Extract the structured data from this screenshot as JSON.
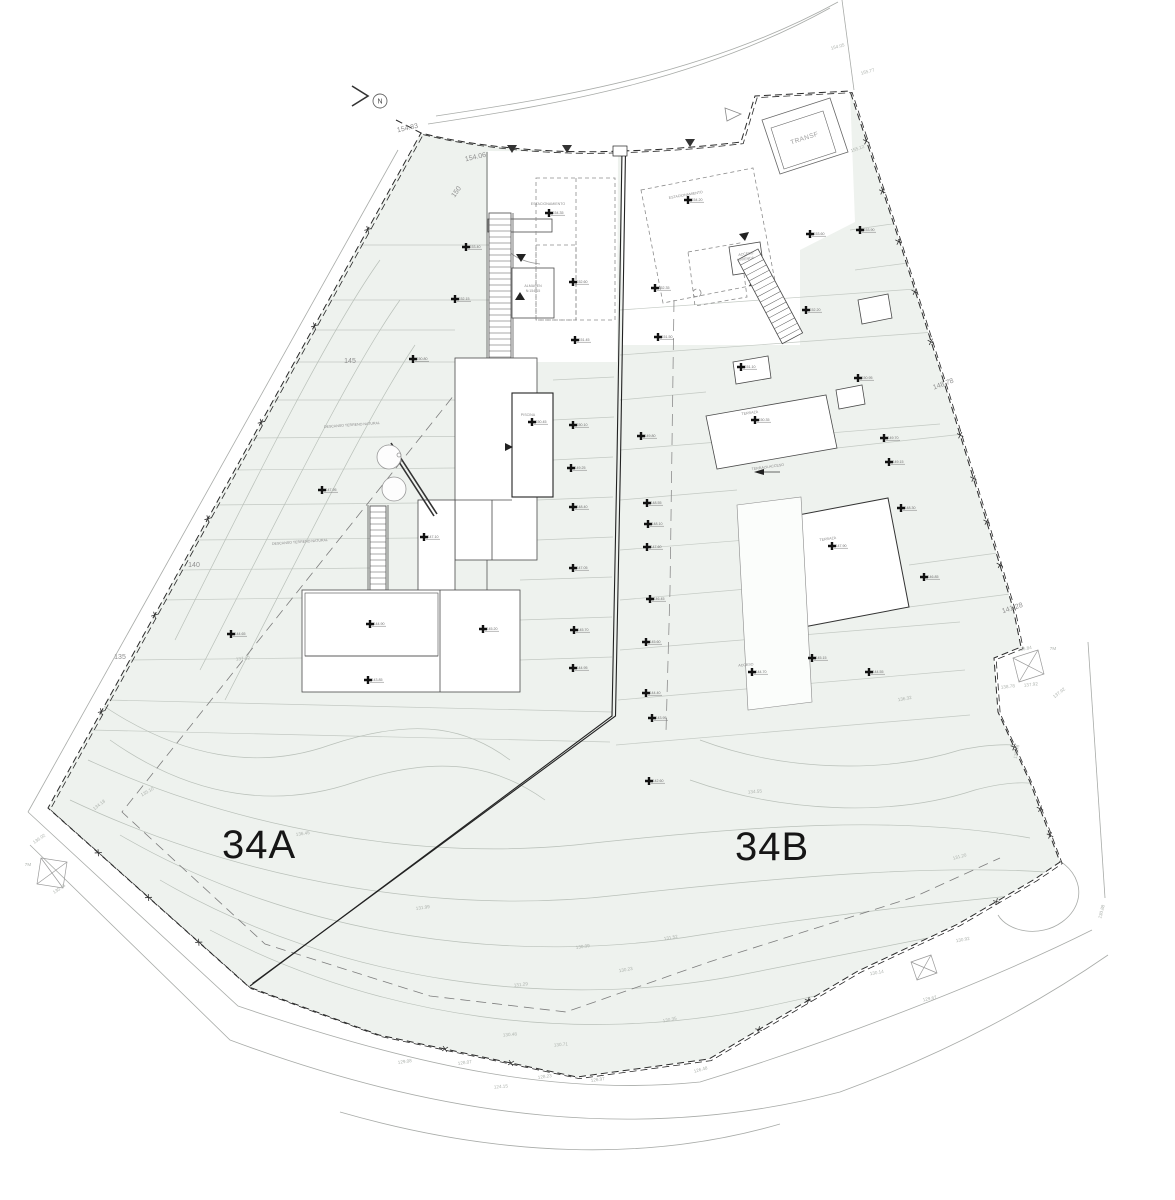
{
  "plan": {
    "parcel_a_label": "34A",
    "parcel_b_label": "34B",
    "north_label": "N",
    "transformer_label": "TRANSF"
  },
  "colors": {
    "terrace_fill": "#eef2ee",
    "line_gray": "#b5bcb5",
    "boundary_black": "#2a2a2a"
  },
  "boundary_labels": [
    {
      "text": "154.83",
      "x": 408,
      "y": 130,
      "rot": -13
    },
    {
      "text": "154.06",
      "x": 476,
      "y": 159,
      "rot": -13
    },
    {
      "text": "150",
      "x": 458,
      "y": 193,
      "rot": -55
    },
    {
      "text": "145",
      "x": 350,
      "y": 363,
      "rot": 0
    },
    {
      "text": "140",
      "x": 194,
      "y": 567,
      "rot": 0
    },
    {
      "text": "135",
      "x": 120,
      "y": 659,
      "rot": 0
    },
    {
      "text": "148.78",
      "x": 944,
      "y": 386,
      "rot": -20
    },
    {
      "text": "141.28",
      "x": 1013,
      "y": 610,
      "rot": -18
    }
  ],
  "contour_labels": [
    {
      "text": "154.05",
      "x": 838,
      "y": 48,
      "rot": -15
    },
    {
      "text": "155.77",
      "x": 868,
      "y": 73,
      "rot": -15
    },
    {
      "text": "155.12",
      "x": 858,
      "y": 150,
      "rot": -20
    },
    {
      "text": "136.84",
      "x": 1025,
      "y": 650,
      "rot": -10
    },
    {
      "text": "138.78",
      "x": 1008,
      "y": 688,
      "rot": -6
    },
    {
      "text": "137.92",
      "x": 1031,
      "y": 686,
      "rot": -6
    },
    {
      "text": "7M",
      "x": 1053,
      "y": 650,
      "rot": 0
    },
    {
      "text": "137.92",
      "x": 1060,
      "y": 694,
      "rot": -38
    },
    {
      "text": "135.78",
      "x": 1018,
      "y": 752,
      "rot": -78
    },
    {
      "text": "130.88",
      "x": 1103,
      "y": 912,
      "rot": -75
    },
    {
      "text": "136.45",
      "x": 303,
      "y": 835,
      "rot": -8
    },
    {
      "text": "137.02",
      "x": 243,
      "y": 660,
      "rot": -5
    },
    {
      "text": "134.18",
      "x": 100,
      "y": 806,
      "rot": -38
    },
    {
      "text": "135.10",
      "x": 148,
      "y": 793,
      "rot": -30
    },
    {
      "text": "136.02",
      "x": 40,
      "y": 840,
      "rot": -35
    },
    {
      "text": "135.46",
      "x": 60,
      "y": 890,
      "rot": -35
    },
    {
      "text": "7M",
      "x": 28,
      "y": 866,
      "rot": 0
    },
    {
      "text": "131.99",
      "x": 423,
      "y": 909,
      "rot": -8
    },
    {
      "text": "131.52",
      "x": 671,
      "y": 939,
      "rot": -10
    },
    {
      "text": "130.99",
      "x": 583,
      "y": 948,
      "rot": -8
    },
    {
      "text": "131.29",
      "x": 521,
      "y": 986,
      "rot": -6
    },
    {
      "text": "130.23",
      "x": 626,
      "y": 971,
      "rot": -10
    },
    {
      "text": "130.48",
      "x": 510,
      "y": 1036,
      "rot": -5
    },
    {
      "text": "130.71",
      "x": 561,
      "y": 1046,
      "rot": -5
    },
    {
      "text": "128.07",
      "x": 465,
      "y": 1064,
      "rot": -8
    },
    {
      "text": "128.23",
      "x": 545,
      "y": 1078,
      "rot": -8
    },
    {
      "text": "126.97",
      "x": 598,
      "y": 1081,
      "rot": -8
    },
    {
      "text": "124.15",
      "x": 501,
      "y": 1088,
      "rot": -5
    },
    {
      "text": "129.08",
      "x": 405,
      "y": 1063,
      "rot": -8
    },
    {
      "text": "126.48",
      "x": 701,
      "y": 1071,
      "rot": -15
    },
    {
      "text": "130.35",
      "x": 670,
      "y": 1021,
      "rot": -12
    },
    {
      "text": "134.55",
      "x": 755,
      "y": 793,
      "rot": -5
    },
    {
      "text": "136.32",
      "x": 905,
      "y": 700,
      "rot": -10
    },
    {
      "text": "131.20",
      "x": 960,
      "y": 858,
      "rot": -15
    },
    {
      "text": "130.92",
      "x": 963,
      "y": 941,
      "rot": -10
    },
    {
      "text": "130.14",
      "x": 877,
      "y": 974,
      "rot": -10
    },
    {
      "text": "129.67",
      "x": 930,
      "y": 1000,
      "rot": -12
    }
  ],
  "building_labels": [
    {
      "text": "DESCANSO TERRENO NATURAL",
      "x": 352,
      "y": 426,
      "rot": -4
    },
    {
      "text": "DESCANSO TERRENO NATURAL",
      "x": 300,
      "y": 543,
      "rot": -4
    },
    {
      "text": "ESTACIONAMIENTO",
      "x": 548,
      "y": 205,
      "rot": 0
    },
    {
      "text": "ESTACIONAMIENTO",
      "x": 686,
      "y": 196,
      "rot": -10
    },
    {
      "text": "TERRAZA ACCESO",
      "x": 768,
      "y": 468,
      "rot": -8
    },
    {
      "text": "PISCINA",
      "x": 528,
      "y": 416,
      "rot": 0
    },
    {
      "text": "TERRAZA",
      "x": 750,
      "y": 414,
      "rot": -8
    },
    {
      "text": "TERRAZA",
      "x": 828,
      "y": 540,
      "rot": -8
    },
    {
      "text": "ACCESO",
      "x": 746,
      "y": 666,
      "rot": -5
    },
    {
      "text": "ALMACEN",
      "x": 533,
      "y": 287,
      "rot": 0
    },
    {
      "text": "N:154.15",
      "x": 533,
      "y": 292,
      "rot": 0
    },
    {
      "text": "ACCESO",
      "x": 746,
      "y": 255,
      "rot": -8
    },
    {
      "text": "VIVIENDA",
      "x": 746,
      "y": 260,
      "rot": -8
    }
  ],
  "spot_markers": [
    {
      "x": 466,
      "y": 247,
      "v": "153.40"
    },
    {
      "x": 455,
      "y": 299,
      "v": "152.15"
    },
    {
      "x": 413,
      "y": 359,
      "v": "150.80"
    },
    {
      "x": 322,
      "y": 490,
      "v": "147.95"
    },
    {
      "x": 424,
      "y": 537,
      "v": "147.10"
    },
    {
      "x": 231,
      "y": 634,
      "v": "144.65"
    },
    {
      "x": 370,
      "y": 624,
      "v": "144.90"
    },
    {
      "x": 483,
      "y": 629,
      "v": "145.20"
    },
    {
      "x": 368,
      "y": 680,
      "v": "143.85"
    },
    {
      "x": 549,
      "y": 213,
      "v": "154.35"
    },
    {
      "x": 532,
      "y": 422,
      "v": "150.45"
    },
    {
      "x": 573,
      "y": 282,
      "v": "152.60"
    },
    {
      "x": 575,
      "y": 340,
      "v": "151.45"
    },
    {
      "x": 573,
      "y": 425,
      "v": "150.10"
    },
    {
      "x": 571,
      "y": 468,
      "v": "149.25"
    },
    {
      "x": 573,
      "y": 507,
      "v": "148.40"
    },
    {
      "x": 573,
      "y": 568,
      "v": "147.05"
    },
    {
      "x": 574,
      "y": 630,
      "v": "145.70"
    },
    {
      "x": 573,
      "y": 668,
      "v": "144.95"
    },
    {
      "x": 655,
      "y": 288,
      "v": "152.35"
    },
    {
      "x": 658,
      "y": 337,
      "v": "151.50"
    },
    {
      "x": 641,
      "y": 436,
      "v": "149.80"
    },
    {
      "x": 647,
      "y": 503,
      "v": "148.55"
    },
    {
      "x": 648,
      "y": 524,
      "v": "148.10"
    },
    {
      "x": 647,
      "y": 547,
      "v": "147.60"
    },
    {
      "x": 650,
      "y": 599,
      "v": "146.45"
    },
    {
      "x": 646,
      "y": 642,
      "v": "145.60"
    },
    {
      "x": 646,
      "y": 693,
      "v": "144.40"
    },
    {
      "x": 652,
      "y": 718,
      "v": "143.95"
    },
    {
      "x": 649,
      "y": 781,
      "v": "142.60"
    },
    {
      "x": 688,
      "y": 200,
      "v": "154.20"
    },
    {
      "x": 741,
      "y": 367,
      "v": "151.10"
    },
    {
      "x": 755,
      "y": 420,
      "v": "150.35"
    },
    {
      "x": 832,
      "y": 546,
      "v": "147.90"
    },
    {
      "x": 812,
      "y": 658,
      "v": "145.15"
    },
    {
      "x": 752,
      "y": 672,
      "v": "144.70"
    },
    {
      "x": 810,
      "y": 234,
      "v": "153.60"
    },
    {
      "x": 858,
      "y": 378,
      "v": "150.95"
    },
    {
      "x": 884,
      "y": 438,
      "v": "149.70"
    },
    {
      "x": 889,
      "y": 462,
      "v": "149.15"
    },
    {
      "x": 901,
      "y": 508,
      "v": "148.30"
    },
    {
      "x": 924,
      "y": 577,
      "v": "146.85"
    },
    {
      "x": 869,
      "y": 672,
      "v": "144.55"
    },
    {
      "x": 860,
      "y": 230,
      "v": "153.90"
    },
    {
      "x": 806,
      "y": 310,
      "v": "152.20"
    }
  ]
}
